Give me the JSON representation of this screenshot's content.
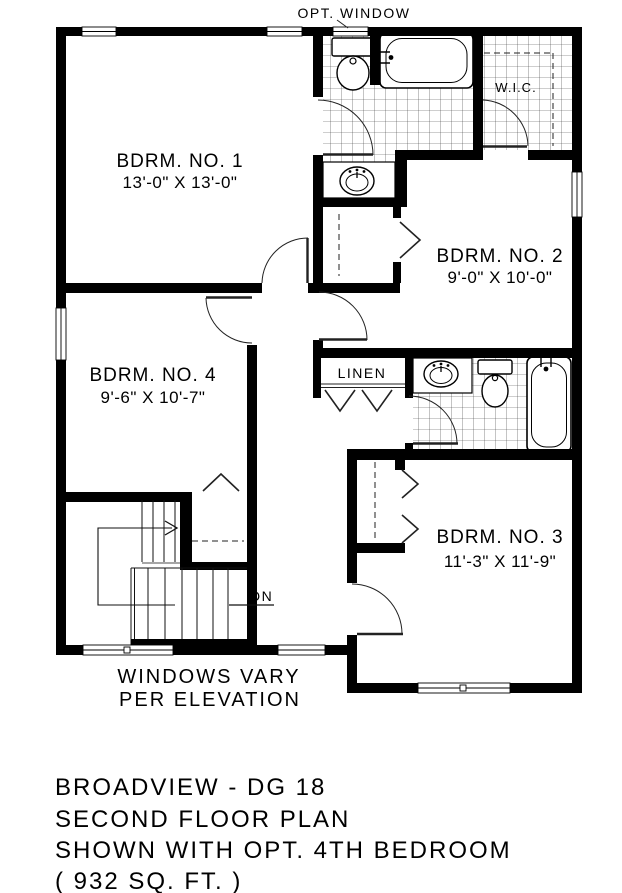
{
  "drawing_title": "Broadview DG 18 second floor plan",
  "annotations": {
    "opt_window": "OPT. WINDOW",
    "windows_vary_line1": "WINDOWS VARY",
    "windows_vary_line2": "PER ELEVATION",
    "down_stairs": "DN",
    "linen": "LINEN",
    "walk_in_closet": "W.I.C."
  },
  "rooms": {
    "bdrm1": {
      "name": "BDRM. NO. 1",
      "dims": "13'-0\" X 13'-0\""
    },
    "bdrm2": {
      "name": "BDRM. NO. 2",
      "dims": "9'-0\" X 10'-0\""
    },
    "bdrm3": {
      "name": "BDRM. NO. 3",
      "dims": "11'-3\" X 11'-9\""
    },
    "bdrm4": {
      "name": "BDRM. NO. 4",
      "dims": "9'-6\" X 10'-7\""
    }
  },
  "title_block": {
    "line1": "BROADVIEW - DG 18",
    "line2": "SECOND FLOOR PLAN",
    "line3": "SHOWN WITH OPT. 4TH BEDROOM",
    "line4": "( 932 SQ. FT. )"
  },
  "colors": {
    "wall": "#000000",
    "background": "#ffffff",
    "line": "#1a1a1a",
    "tile_line": "#3a3a3a"
  }
}
